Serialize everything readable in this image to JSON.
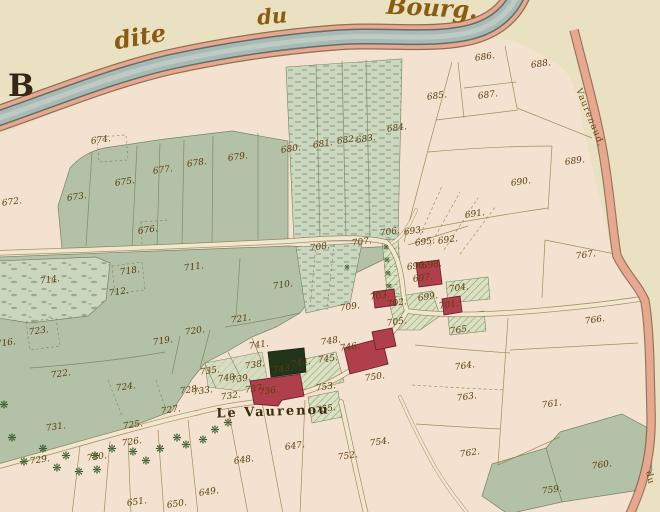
{
  "map": {
    "sheet_letter": "B",
    "place_labels": [
      {
        "t": "dite",
        "x": 140,
        "y": 37,
        "s": 24,
        "rot": -10,
        "cls": "script"
      },
      {
        "t": "du",
        "x": 272,
        "y": 16,
        "s": 21,
        "rot": -5,
        "cls": "script"
      },
      {
        "t": "Bourg.",
        "x": 432,
        "y": 8,
        "s": 24,
        "rot": 3,
        "cls": "script"
      },
      {
        "t": "Le Vaurenou",
        "x": 273,
        "y": 412,
        "s": 13,
        "rot": -2,
        "cls": "place"
      },
      {
        "t": "Vaurenaud.",
        "x": 589,
        "y": 118,
        "s": 9,
        "rot": 68,
        "cls": "road-label"
      },
      {
        "t": "du",
        "x": 649,
        "y": 478,
        "s": 9,
        "rot": 78,
        "cls": "road-label"
      }
    ],
    "parcel_numbers": [
      {
        "t": "647.",
        "x": 295,
        "y": 447
      },
      {
        "t": "648.",
        "x": 244,
        "y": 461
      },
      {
        "t": "649.",
        "x": 209,
        "y": 493
      },
      {
        "t": "650.",
        "x": 177,
        "y": 505
      },
      {
        "t": "651.",
        "x": 137,
        "y": 503
      },
      {
        "t": "672.",
        "x": 12,
        "y": 203
      },
      {
        "t": "673.",
        "x": 77,
        "y": 198
      },
      {
        "t": "674.",
        "x": 101,
        "y": 141
      },
      {
        "t": "675.",
        "x": 125,
        "y": 183
      },
      {
        "t": "676.",
        "x": 148,
        "y": 231
      },
      {
        "t": "677.",
        "x": 163,
        "y": 171
      },
      {
        "t": "678.",
        "x": 197,
        "y": 164
      },
      {
        "t": "679.",
        "x": 238,
        "y": 158
      },
      {
        "t": "680.",
        "x": 291,
        "y": 150
      },
      {
        "t": "681.",
        "x": 323,
        "y": 145
      },
      {
        "t": "682.",
        "x": 347,
        "y": 141
      },
      {
        "t": "683.",
        "x": 366,
        "y": 140
      },
      {
        "t": "684.",
        "x": 397,
        "y": 129
      },
      {
        "t": "685.",
        "x": 437,
        "y": 97
      },
      {
        "t": "686.",
        "x": 485,
        "y": 58
      },
      {
        "t": "687.",
        "x": 488,
        "y": 96
      },
      {
        "t": "688.",
        "x": 541,
        "y": 65
      },
      {
        "t": "689.",
        "x": 575,
        "y": 162
      },
      {
        "t": "690.",
        "x": 521,
        "y": 183
      },
      {
        "t": "691.",
        "x": 475,
        "y": 215
      },
      {
        "t": "692.",
        "x": 448,
        "y": 241
      },
      {
        "t": "693.",
        "x": 414,
        "y": 232
      },
      {
        "t": "695.",
        "x": 425,
        "y": 243
      },
      {
        "t": "696.",
        "x": 417,
        "y": 267
      },
      {
        "t": "697.",
        "x": 423,
        "y": 279
      },
      {
        "t": "698.",
        "x": 432,
        "y": 266
      },
      {
        "t": "699.",
        "x": 428,
        "y": 298
      },
      {
        "t": "701.",
        "x": 449,
        "y": 306
      },
      {
        "t": "702.",
        "x": 397,
        "y": 304
      },
      {
        "t": "703.",
        "x": 380,
        "y": 297
      },
      {
        "t": "704.",
        "x": 459,
        "y": 289
      },
      {
        "t": "705.",
        "x": 397,
        "y": 323
      },
      {
        "t": "706.",
        "x": 390,
        "y": 233
      },
      {
        "t": "707.",
        "x": 362,
        "y": 243
      },
      {
        "t": "708.",
        "x": 320,
        "y": 248
      },
      {
        "t": "709.",
        "x": 350,
        "y": 308
      },
      {
        "t": "710.",
        "x": 283,
        "y": 286
      },
      {
        "t": "711.",
        "x": 194,
        "y": 268
      },
      {
        "t": "712.",
        "x": 119,
        "y": 293
      },
      {
        "t": "714.",
        "x": 50,
        "y": 281
      },
      {
        "t": "716.",
        "x": 6,
        "y": 344
      },
      {
        "t": "718.",
        "x": 130,
        "y": 272
      },
      {
        "t": "719.",
        "x": 163,
        "y": 342
      },
      {
        "t": "720.",
        "x": 195,
        "y": 332
      },
      {
        "t": "721.",
        "x": 241,
        "y": 320
      },
      {
        "t": "722.",
        "x": 61,
        "y": 375
      },
      {
        "t": "723.",
        "x": 39,
        "y": 332
      },
      {
        "t": "724.",
        "x": 126,
        "y": 388
      },
      {
        "t": "725.",
        "x": 133,
        "y": 426
      },
      {
        "t": "726.",
        "x": 132,
        "y": 443
      },
      {
        "t": "727.",
        "x": 171,
        "y": 411
      },
      {
        "t": "728.",
        "x": 190,
        "y": 391
      },
      {
        "t": "729.",
        "x": 40,
        "y": 461
      },
      {
        "t": "730.",
        "x": 97,
        "y": 458
      },
      {
        "t": "731.",
        "x": 56,
        "y": 428
      },
      {
        "t": "732.",
        "x": 231,
        "y": 397
      },
      {
        "t": "733.",
        "x": 203,
        "y": 392
      },
      {
        "t": "735.",
        "x": 210,
        "y": 372
      },
      {
        "t": "736.",
        "x": 269,
        "y": 392
      },
      {
        "t": "737.",
        "x": 255,
        "y": 390
      },
      {
        "t": "738.",
        "x": 255,
        "y": 366
      },
      {
        "t": "739.",
        "x": 241,
        "y": 380
      },
      {
        "t": "740.",
        "x": 228,
        "y": 379
      },
      {
        "t": "741.",
        "x": 259,
        "y": 346
      },
      {
        "t": "743.",
        "x": 283,
        "y": 370
      },
      {
        "t": "744.",
        "x": 301,
        "y": 364
      },
      {
        "t": "745.",
        "x": 328,
        "y": 360
      },
      {
        "t": "746.",
        "x": 350,
        "y": 348
      },
      {
        "t": "748.",
        "x": 331,
        "y": 342
      },
      {
        "t": "750.",
        "x": 375,
        "y": 378
      },
      {
        "t": "752.",
        "x": 348,
        "y": 457
      },
      {
        "t": "753.",
        "x": 326,
        "y": 388
      },
      {
        "t": "754.",
        "x": 380,
        "y": 443
      },
      {
        "t": "755.",
        "x": 326,
        "y": 410
      },
      {
        "t": "759.",
        "x": 552,
        "y": 491
      },
      {
        "t": "760.",
        "x": 602,
        "y": 466
      },
      {
        "t": "761.",
        "x": 552,
        "y": 405
      },
      {
        "t": "762.",
        "x": 470,
        "y": 454
      },
      {
        "t": "763.",
        "x": 467,
        "y": 398
      },
      {
        "t": "764.",
        "x": 465,
        "y": 367
      },
      {
        "t": "765.",
        "x": 460,
        "y": 331
      },
      {
        "t": "766.",
        "x": 595,
        "y": 321
      },
      {
        "t": "767.",
        "x": 586,
        "y": 256
      }
    ],
    "tree_glyph": "❋",
    "trees": {
      "large": [
        [
          4,
          405
        ],
        [
          12,
          438
        ],
        [
          24,
          462
        ],
        [
          43,
          449
        ],
        [
          57,
          468
        ],
        [
          66,
          456
        ],
        [
          79,
          472
        ],
        [
          95,
          456
        ],
        [
          97,
          470
        ],
        [
          112,
          449
        ],
        [
          133,
          452
        ],
        [
          146,
          461
        ],
        [
          160,
          449
        ],
        [
          177,
          438
        ],
        [
          186,
          445
        ],
        [
          203,
          440
        ],
        [
          215,
          430
        ],
        [
          228,
          423
        ]
      ],
      "small": [
        [
          386,
          248
        ],
        [
          387,
          261
        ],
        [
          388,
          274
        ],
        [
          389,
          287
        ],
        [
          347,
          268
        ]
      ]
    },
    "palette": {
      "paper": "#eae0c2",
      "land": "#f3e2d0",
      "meadow": "#b3c1a6",
      "strip": "#ccd7bf",
      "speckbase": "#cbd7bd",
      "speckle": "#8ba184",
      "river": "#a8bab3",
      "riveredge": "#5f6f69",
      "bank": "#e8a78f",
      "bankline": "#7a5a42",
      "road": "#f0e7cf",
      "roadline": "#8a6b45",
      "bline": "#98824f",
      "gline": "#768560",
      "gardenbase": "#dde1c4",
      "hatch": "#8ea77c",
      "building": "#b03f4c",
      "buildingline": "#6e2230",
      "darkparcel": "#22351b",
      "ink": "#5b3c0e",
      "tree": "#2d5424"
    }
  }
}
